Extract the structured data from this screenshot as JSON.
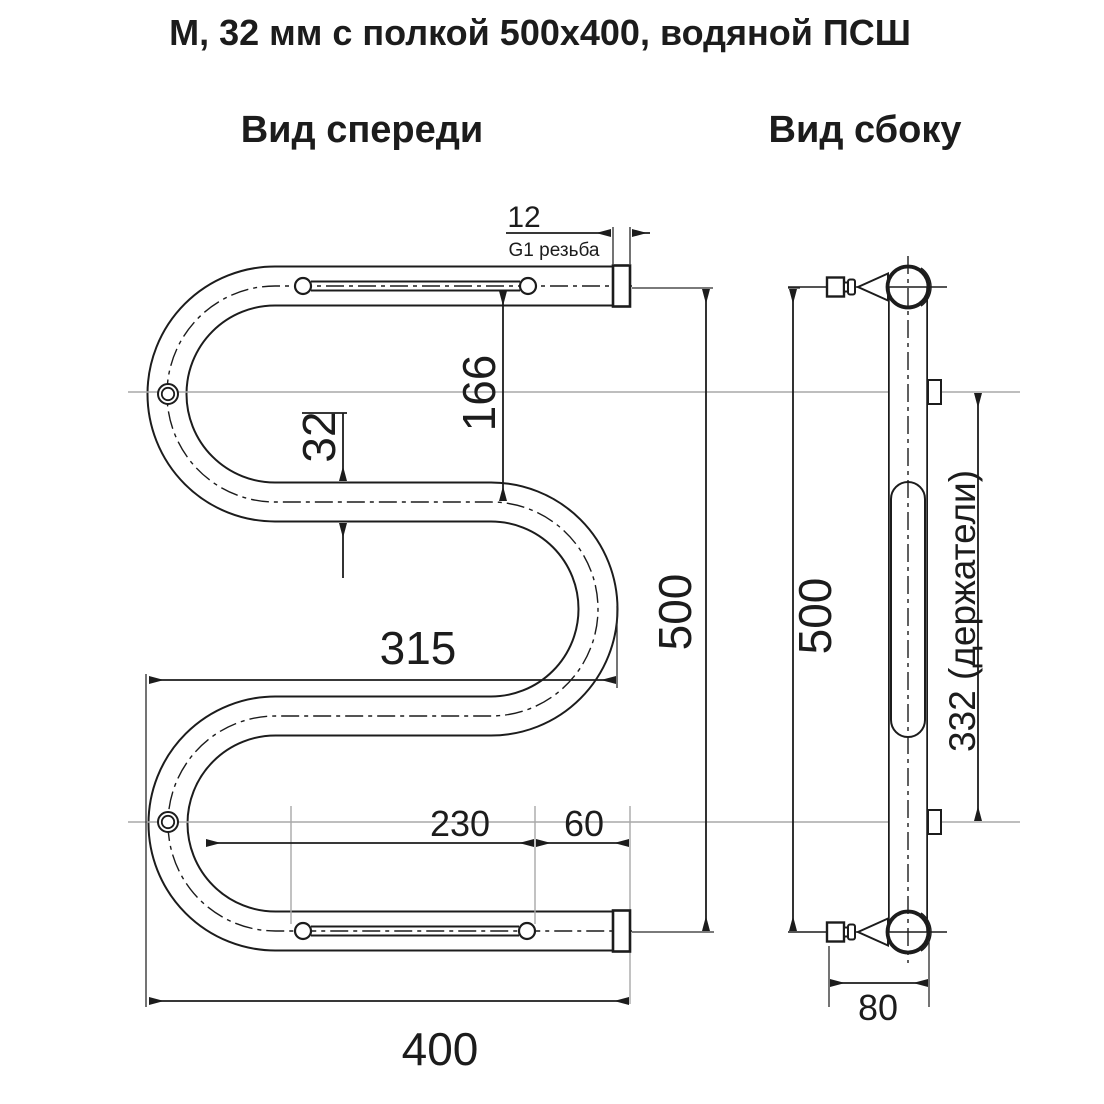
{
  "title": "М, 32 мм с полкой 500х400, водяной ПСШ",
  "views": {
    "front": {
      "label": "Вид спереди"
    },
    "side": {
      "label": "Вид сбоку"
    }
  },
  "dims": {
    "thread_len": "12",
    "thread_note": "G1 резьба",
    "shelf_drop": "166",
    "pipe_dia": "32",
    "inner_width": "315",
    "front_height": "500",
    "rod_len": "230",
    "rod_end": "60",
    "total_width": "400",
    "side_height": "500",
    "holders": "332 (держатели)",
    "depth": "80"
  },
  "colors": {
    "ink": "#1c1c1c",
    "construction": "#a9a9a9",
    "background": "#ffffff"
  }
}
